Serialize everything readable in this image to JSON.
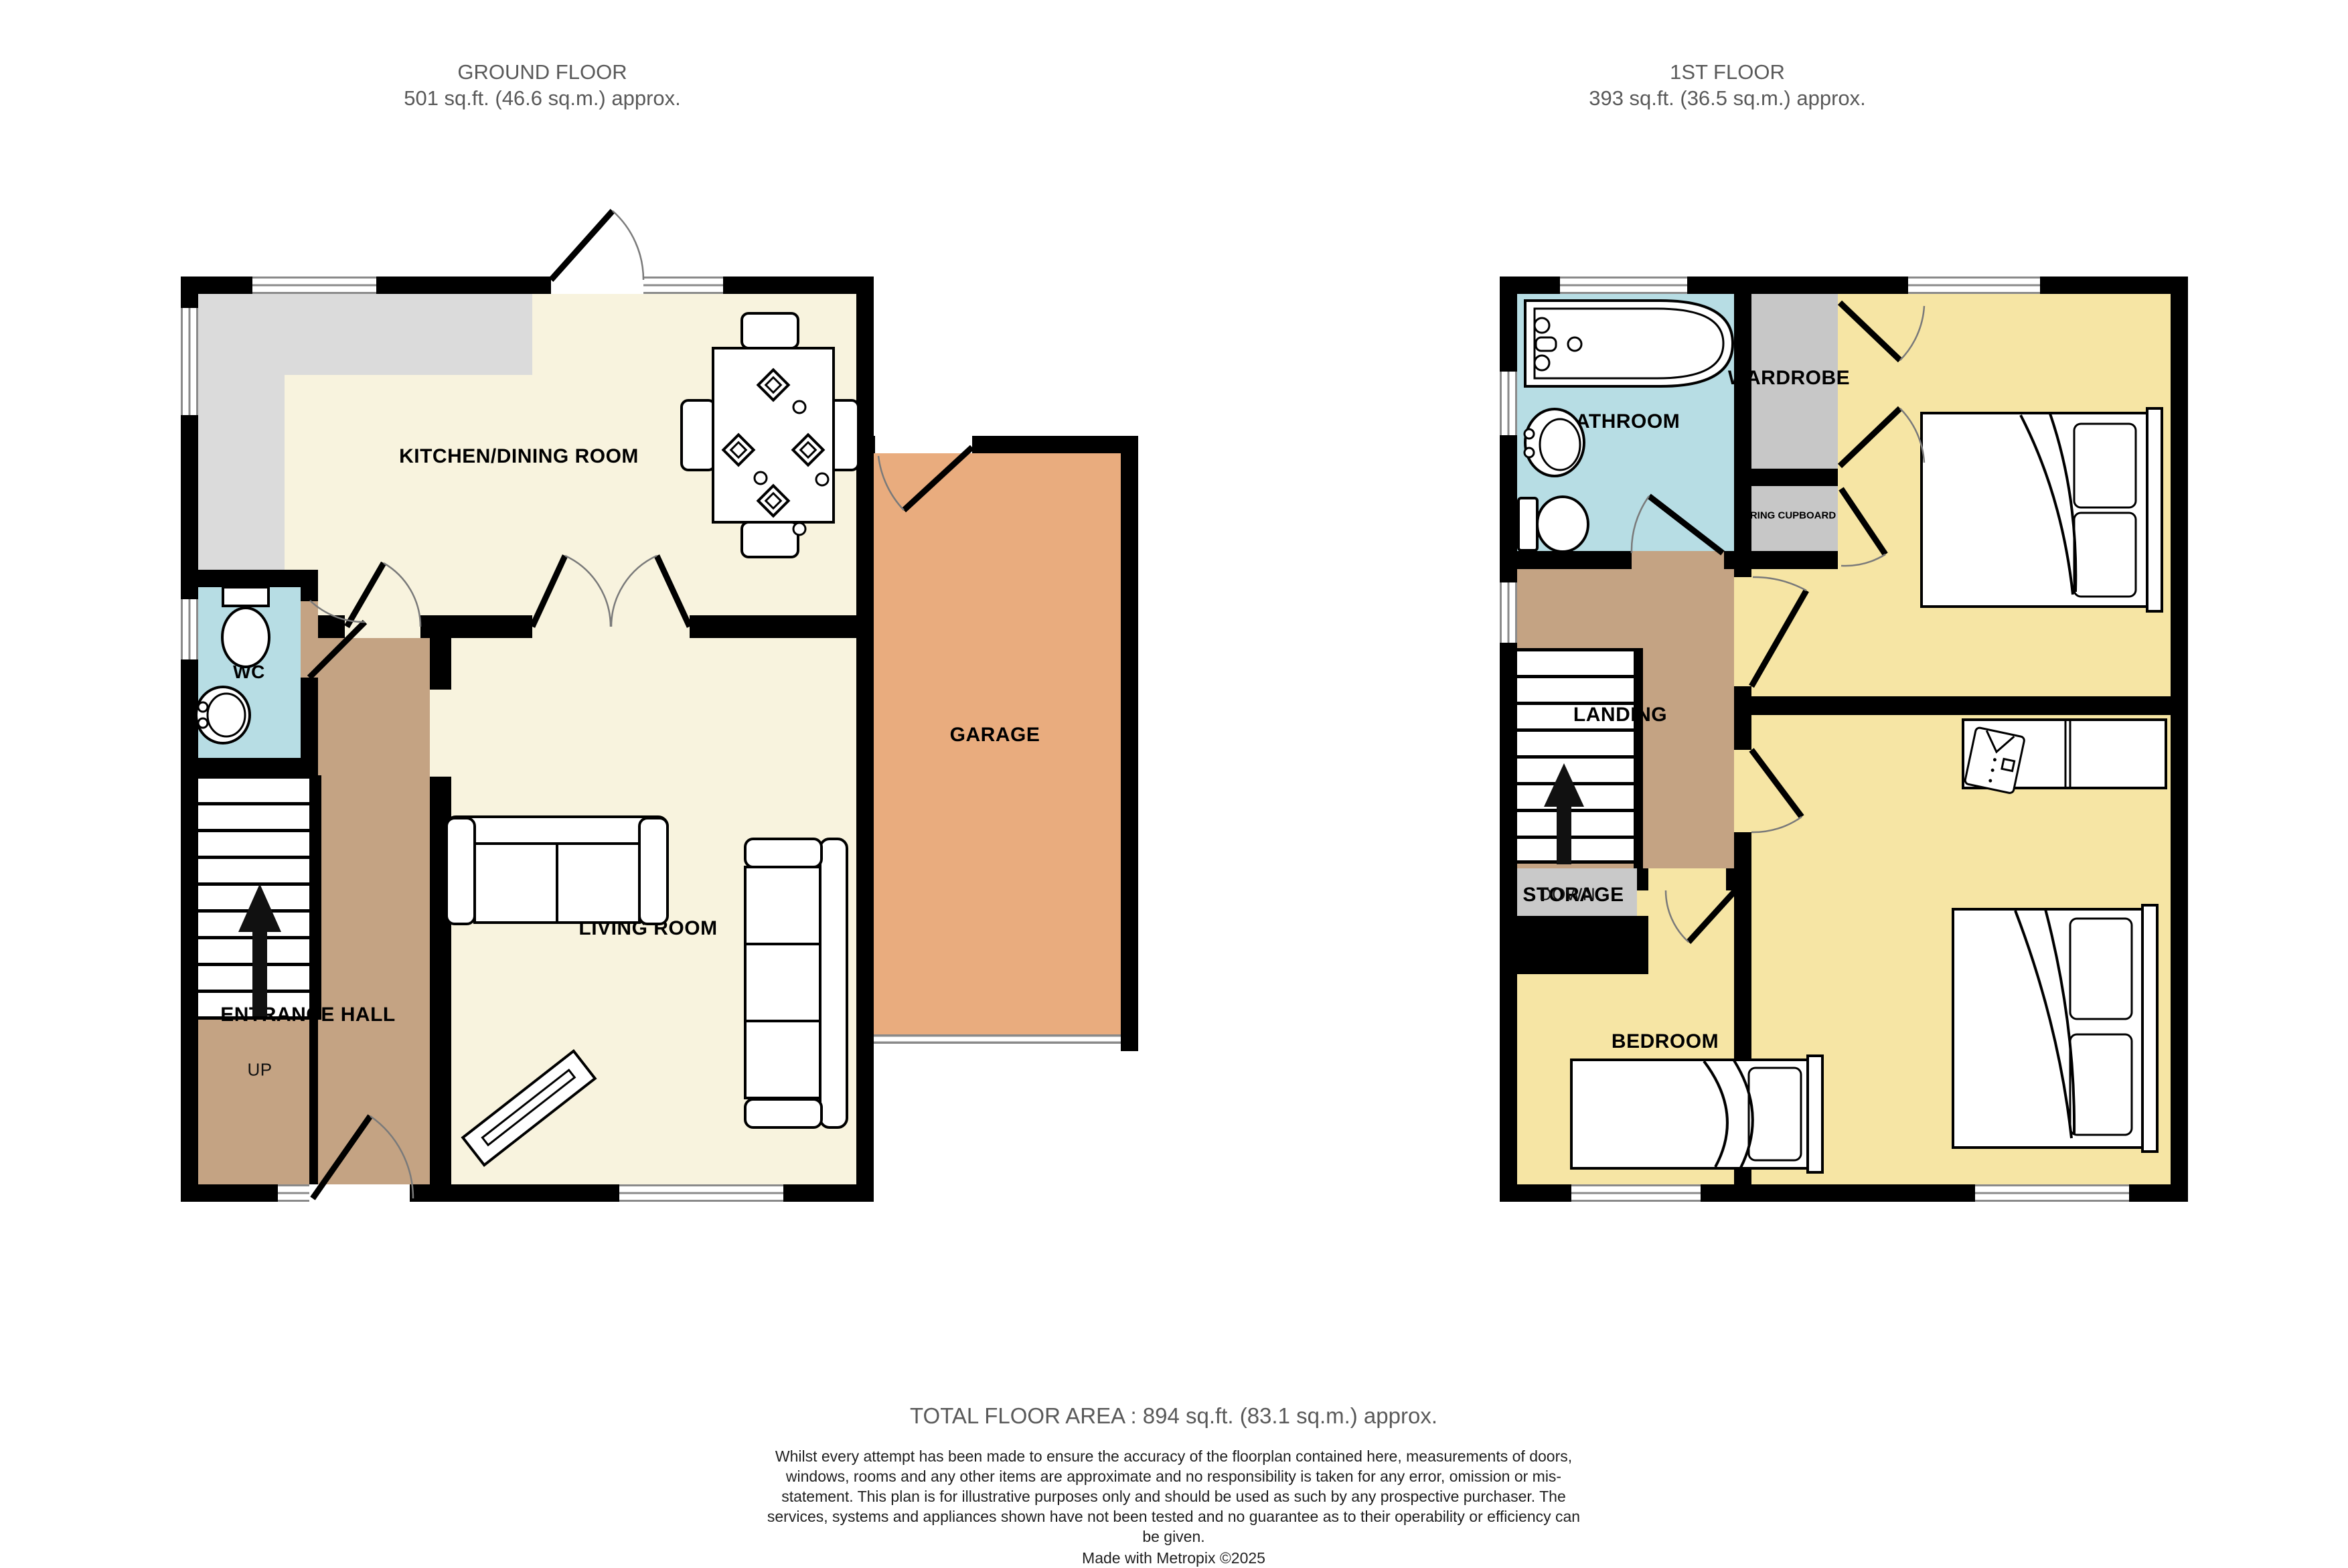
{
  "ground_floor": {
    "title": "GROUND FLOOR",
    "area": "501 sq.ft. (46.6 sq.m.) approx.",
    "rooms": {
      "kitchen": "KITCHEN/DINING ROOM",
      "wc": "WC",
      "entrance_hall": "ENTRANCE HALL",
      "living_room": "LIVING ROOM",
      "garage": "GARAGE"
    },
    "stairs_label": "UP"
  },
  "first_floor": {
    "title": "1ST FLOOR",
    "area": "393 sq.ft. (36.5 sq.m.) approx.",
    "rooms": {
      "bathroom": "BATHROOM",
      "wardrobe": "WARDROBE",
      "airing_cupboard": "RING CUPBOARD",
      "bedroom_front": "BEDROOM",
      "bedroom_back": "BEDROOM",
      "bedroom_single": "BEDROOM",
      "landing": "LANDING",
      "storage": "STORAGE"
    },
    "stairs_label": "DOWN"
  },
  "footer": {
    "total_area": "TOTAL FLOOR AREA : 894 sq.ft. (83.1 sq.m.) approx.",
    "disclaimer": "Whilst every attempt has been made to ensure the accuracy of the floorplan contained here, measurements of doors, windows, rooms and any other items are approximate and no responsibility is taken for any error, omission or mis-statement. This plan is for illustrative purposes only and should be used as such by any prospective purchaser. The services, systems and appliances shown have not been tested and no guarantee as to their operability or efficiency can be given.",
    "credit": "Made with Metropix ©2025"
  },
  "colors": {
    "wall": "#000000",
    "cream": "#F8F3DE",
    "yellow": "#F6E5A4",
    "brown": "#C4A383",
    "blue": "#B7DDE4",
    "garage": "#E9AC7E",
    "counter": "#DBDBDB",
    "closet": "#C7C7C7",
    "storage": "#C9C9C9",
    "wg": "#8A8A8A",
    "title": "#595959",
    "ink": "#1F1F1F"
  }
}
